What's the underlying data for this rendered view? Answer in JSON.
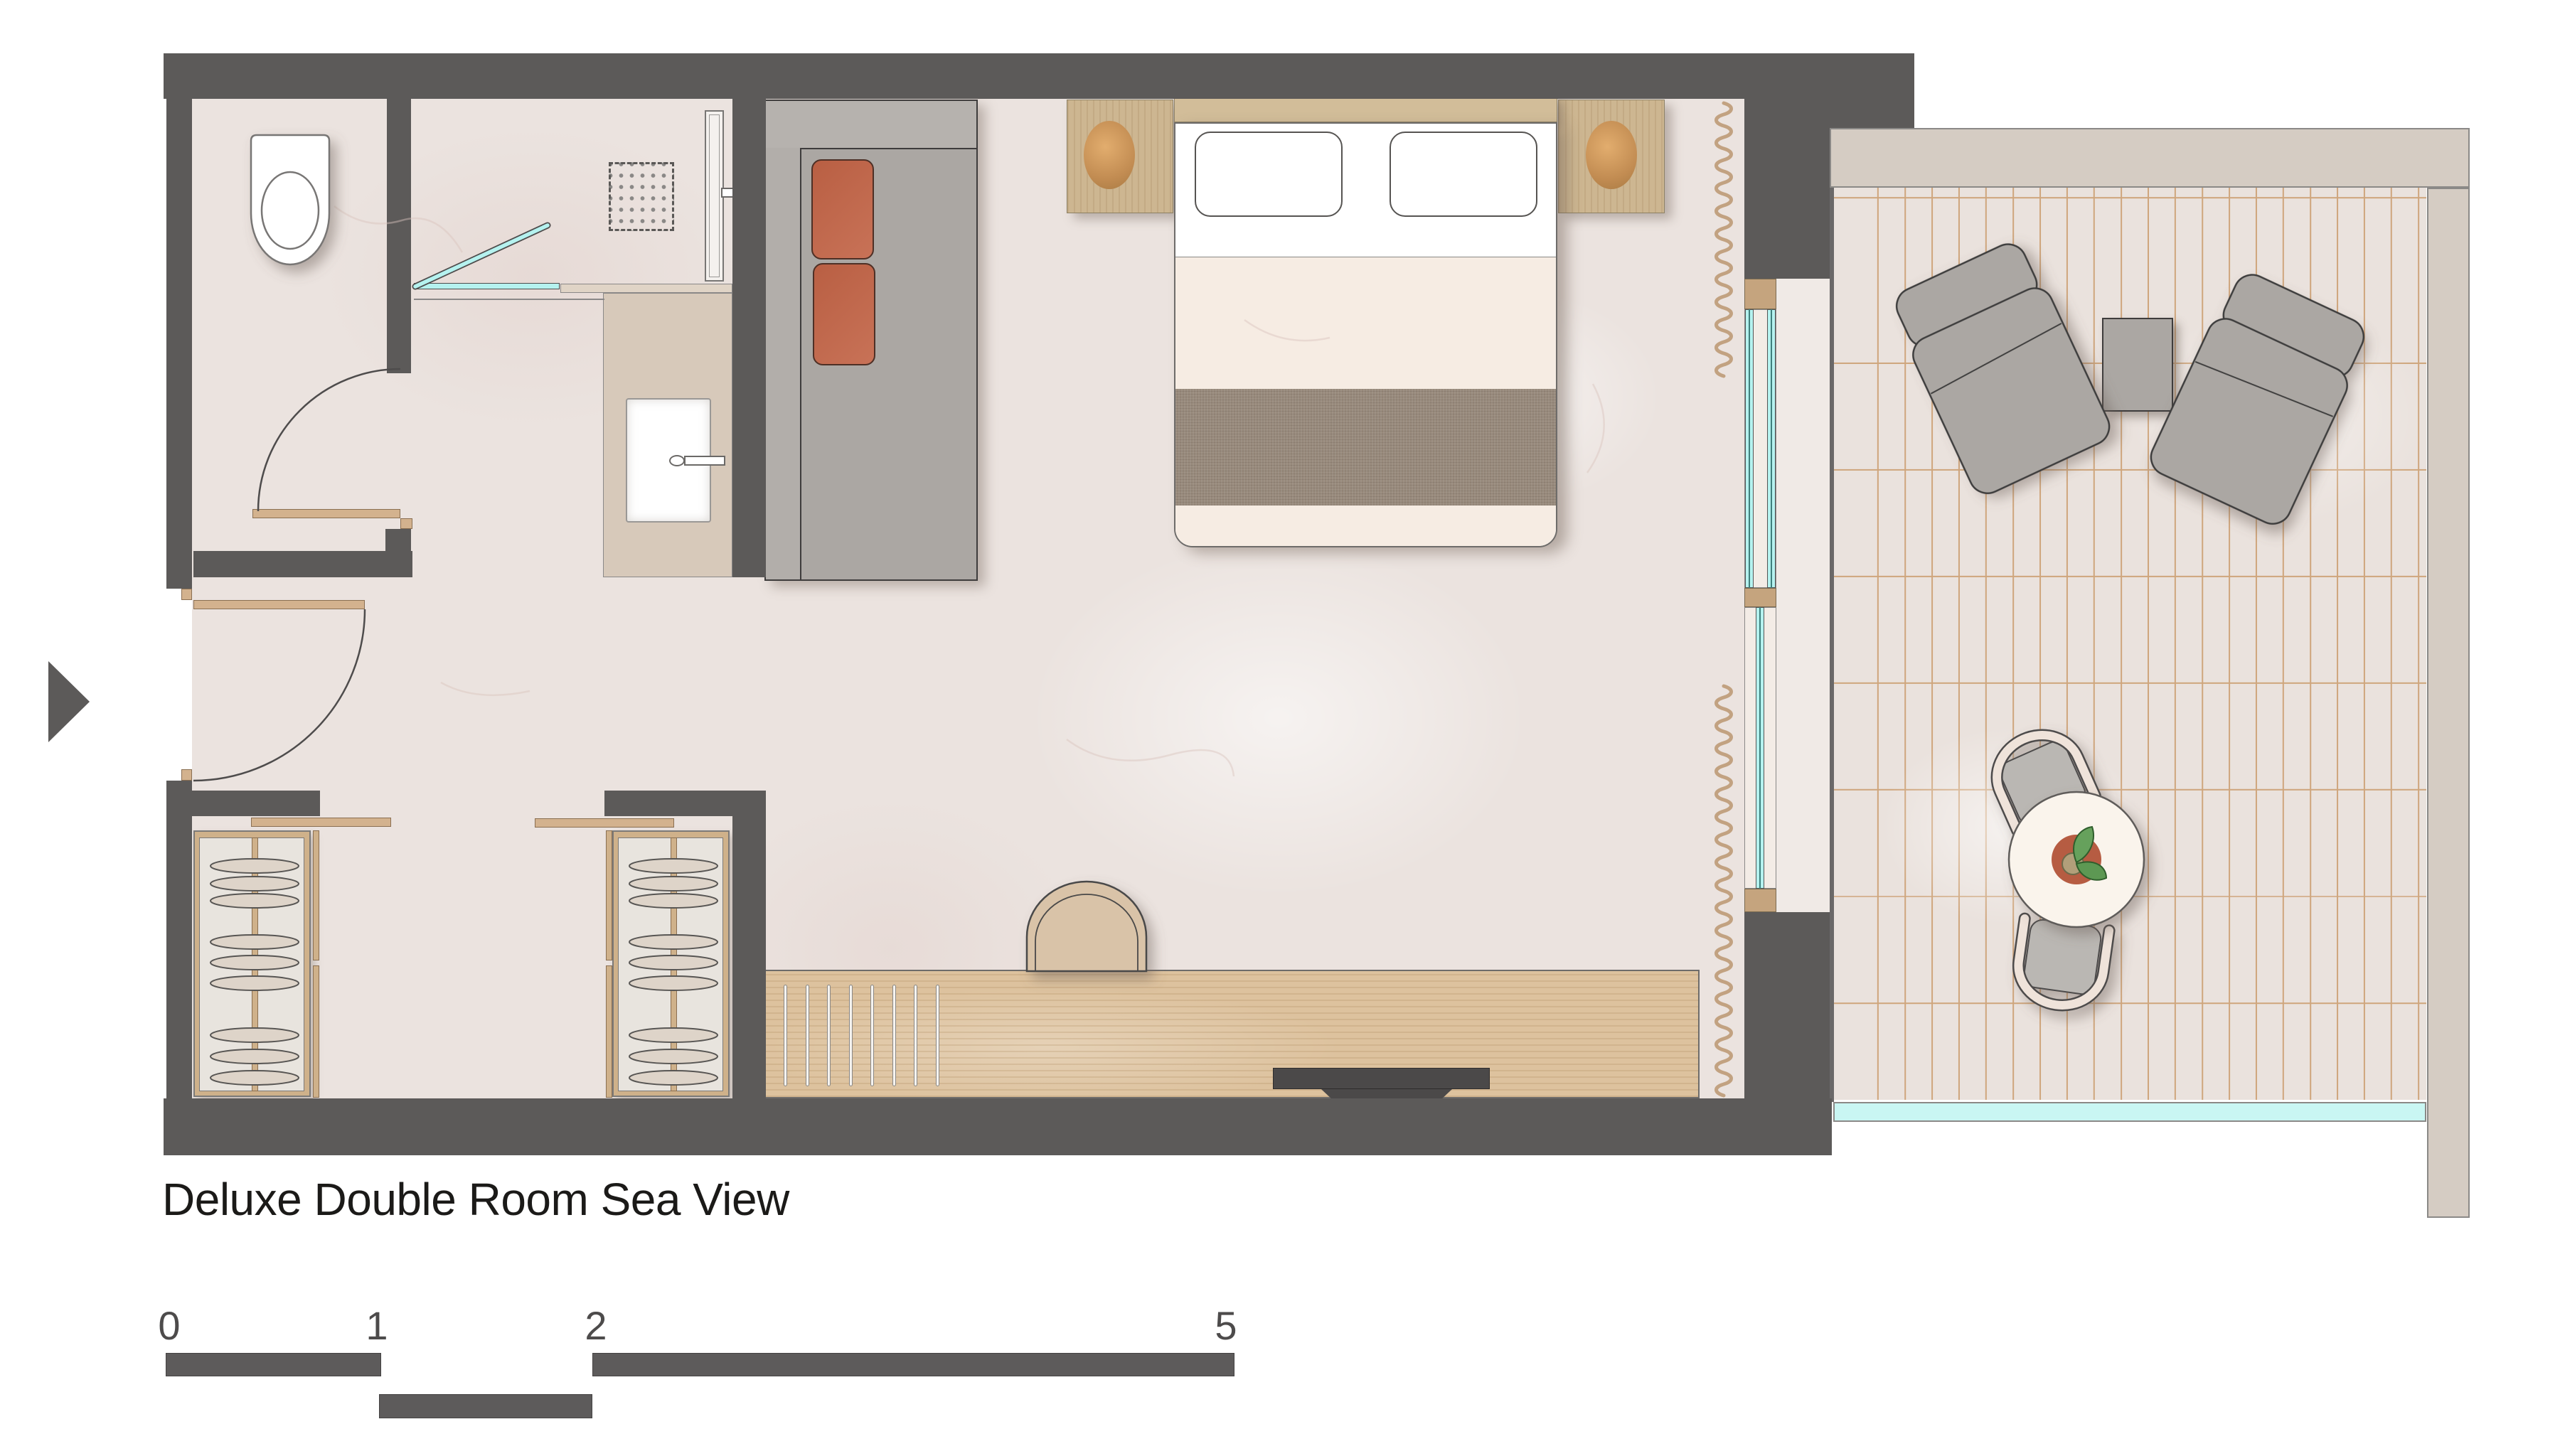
{
  "title": "Deluxe Double Room Sea View",
  "scale_bar": {
    "labels": [
      "0",
      "1",
      "2",
      "5"
    ]
  },
  "furniture": [
    "entrance-arrow",
    "toilet",
    "shower-head",
    "shower-glass-door",
    "shower-panel",
    "vanity-sink",
    "faucet",
    "bathroom-door",
    "entry-door",
    "sofa",
    "sofa-cushions",
    "double-bed",
    "pillows",
    "headboard",
    "nightstands",
    "lamps",
    "wardrobe-left",
    "wardrobe-right",
    "clothes-hangers",
    "desk",
    "desk-chair",
    "tv",
    "sliding-window",
    "curtains",
    "lounge-chair-left",
    "lounge-chair-right",
    "side-table",
    "dining-table",
    "dining-chairs",
    "plant",
    "balcony-railing"
  ],
  "colors": {
    "wall": "#5c5a59",
    "floor": "#ebe3df",
    "wood": "#d3b28e",
    "wood_dark": "#c5a47e",
    "desk_wood": "#ddc29e",
    "terracotta": "#c56a4d",
    "glass": "#b5f2ef",
    "tile": "#eae2dd",
    "grout": "#cfa67d",
    "band": "#d5ccc3",
    "gray_furniture": "#aba7a3",
    "bed_band": "#97897b",
    "cream": "#f6ece3",
    "outline": "#3e3c3c",
    "text": "#1b1a18",
    "scale": "#5d5b5b"
  }
}
